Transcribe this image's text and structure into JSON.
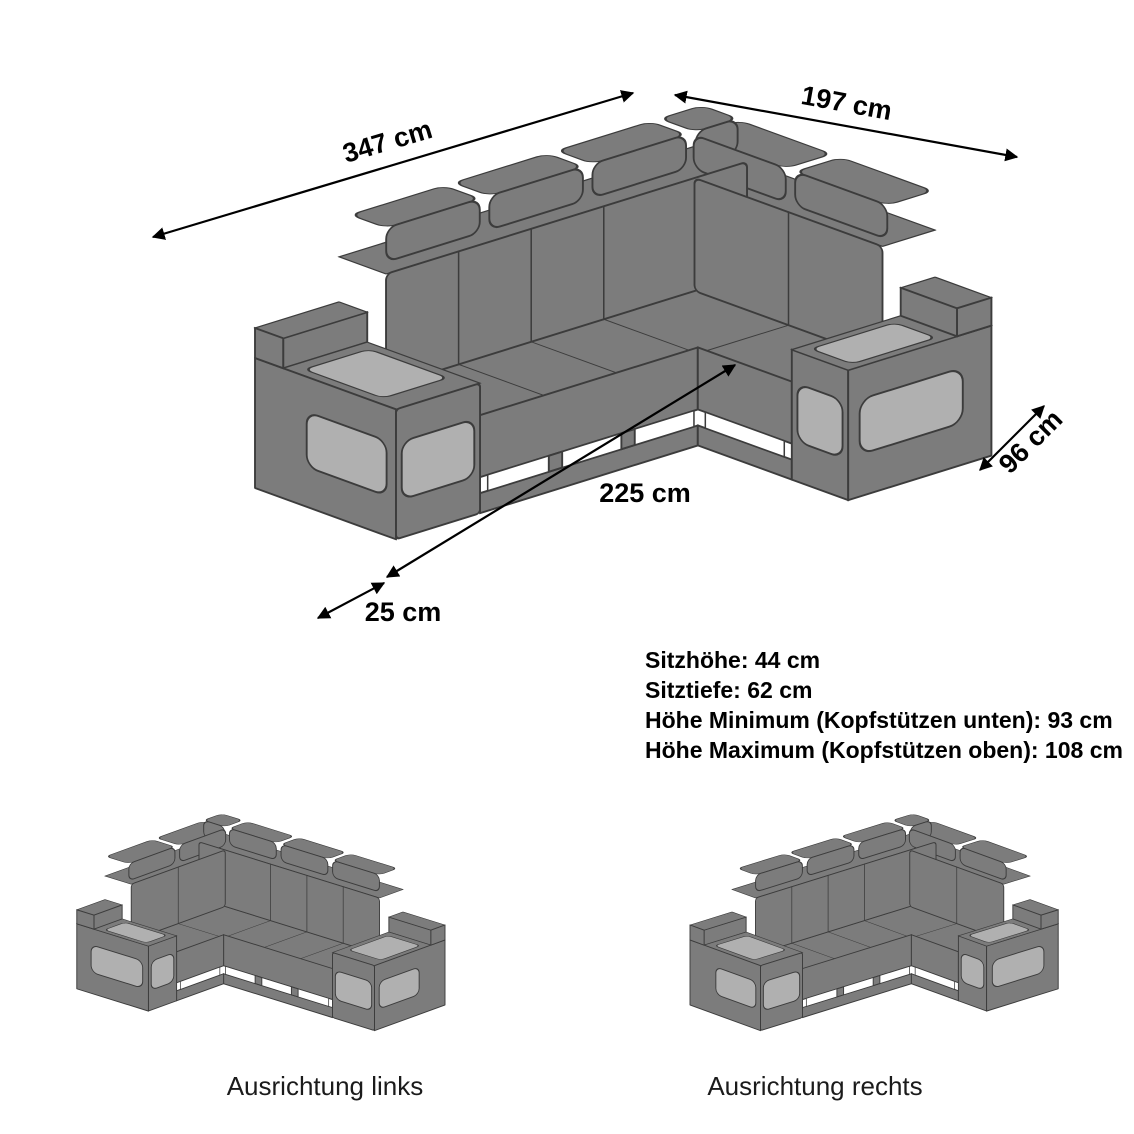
{
  "diagram": {
    "title_area": {},
    "dimensions": {
      "back_width": "347 cm",
      "right_width": "197 cm",
      "right_depth": "96 cm",
      "front_length": "225 cm",
      "front_offset": "25 cm"
    },
    "specs": {
      "seat_height": "Sitzhöhe: 44 cm",
      "seat_depth": "Sitztiefe: 62 cm",
      "height_min": "Höhe Minimum (Kopfstützen unten): 93 cm",
      "height_max": "Höhe Maximum (Kopfstützen oben): 108 cm"
    },
    "variants": {
      "left_label": "Ausrichtung links",
      "right_label": "Ausrichtung rechts"
    },
    "colors": {
      "sofa_body": "#7c7c7c",
      "sofa_outline": "#3c3c3c",
      "sofa_panel": "#b0b0b0",
      "led_slot": "#ffffff",
      "text": "#000000",
      "background": "#ffffff"
    }
  }
}
